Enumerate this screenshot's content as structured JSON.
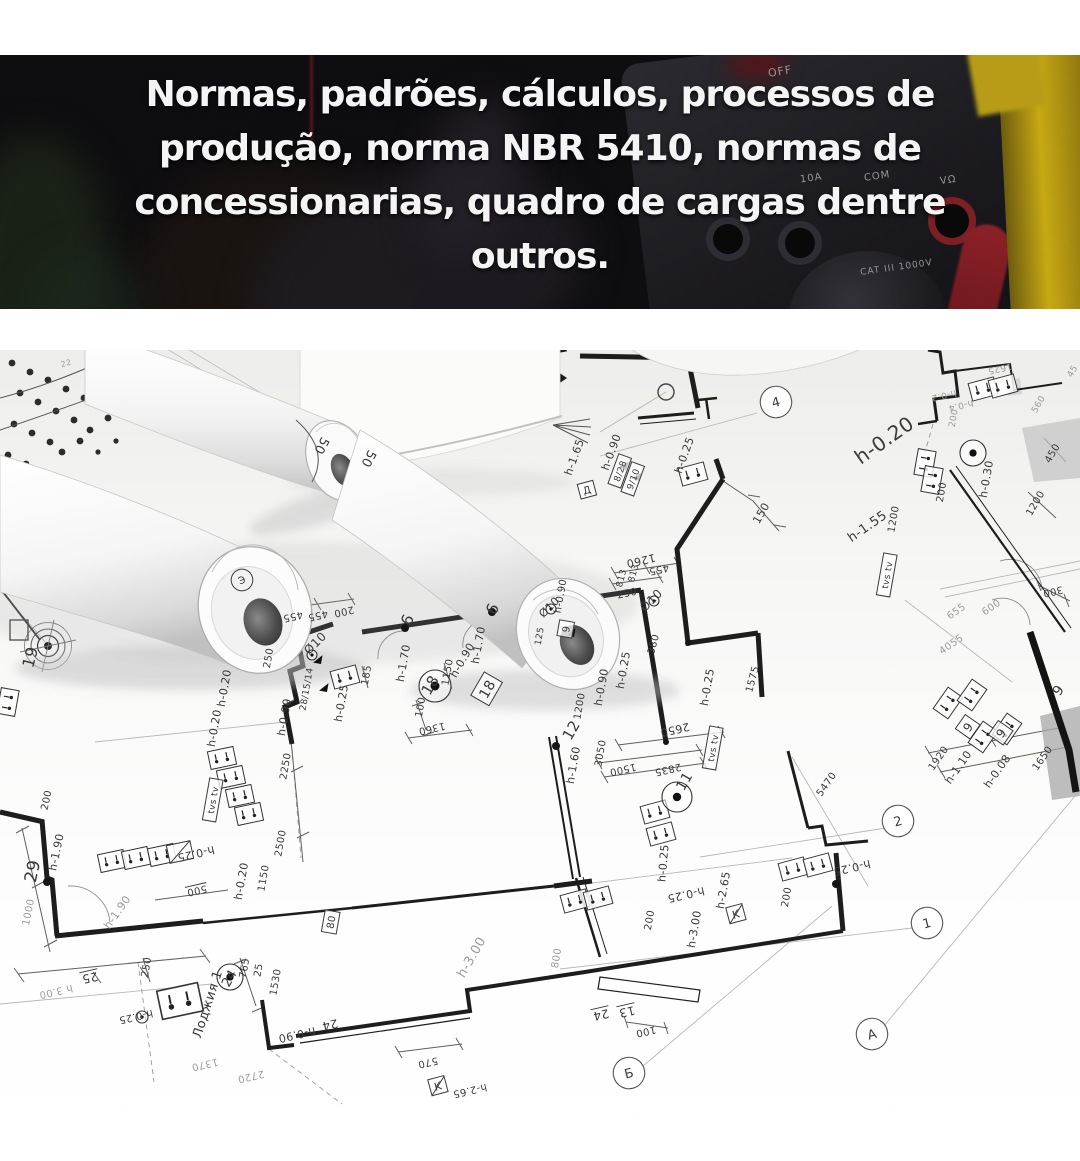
{
  "header": {
    "lines": [
      "Normas, padrões, cálculos, processos de",
      "produção, norma NBR 5410, normas de",
      "concessionarias, quadro de cargas dentre",
      "outros."
    ]
  },
  "photo": {
    "device": "multimeter",
    "accent_yellow": "#c7a912",
    "accent_red": "#7d2026",
    "labels": [
      {
        "t": "OFF",
        "x": 768,
        "y": 10,
        "r": -10,
        "s": 11
      },
      {
        "t": "10A",
        "x": 800,
        "y": 118,
        "r": -8,
        "s": 10
      },
      {
        "t": "COM",
        "x": 864,
        "y": 116,
        "r": -8,
        "s": 10
      },
      {
        "t": "VΩ",
        "x": 940,
        "y": 120,
        "r": -8,
        "s": 10
      },
      {
        "t": "CAT III 1000V",
        "x": 860,
        "y": 208,
        "r": -8,
        "s": 9
      }
    ]
  },
  "blueprint": {
    "labels": [
      {
        "t": "50",
        "x": 322,
        "y": 446,
        "r": 118,
        "s": 13
      },
      {
        "t": "50",
        "x": 369,
        "y": 459,
        "r": 118,
        "s": 13
      },
      {
        "t": "Э",
        "x": 242,
        "y": 580,
        "r": -20,
        "s": 10,
        "o": 1
      },
      {
        "t": "19",
        "x": 30,
        "y": 657,
        "r": -75,
        "s": 16
      },
      {
        "t": "22",
        "x": 66,
        "y": 363,
        "r": -15,
        "s": 8,
        "f": 1
      },
      {
        "t": "4",
        "x": 776,
        "y": 402,
        "r": -15,
        "s": 13,
        "bub": 1
      },
      {
        "t": "h-1.65",
        "x": 574,
        "y": 457,
        "r": -70,
        "s": 11
      },
      {
        "t": "Д",
        "x": 587,
        "y": 490,
        "r": -15,
        "s": 10,
        "box": 1
      },
      {
        "t": "h-0.90",
        "x": 611,
        "y": 452,
        "r": -70,
        "s": 11
      },
      {
        "t": "8/28",
        "x": 620,
        "y": 471,
        "r": -70,
        "s": 9,
        "box": 1
      },
      {
        "t": "9/10",
        "x": 633,
        "y": 479,
        "r": -70,
        "s": 9,
        "box": 1
      },
      {
        "t": "h-0.25",
        "x": 684,
        "y": 455,
        "r": -70,
        "s": 11
      },
      {
        "t": "150",
        "x": 761,
        "y": 513,
        "r": -60,
        "s": 11
      },
      {
        "t": "1260",
        "x": 641,
        "y": 561,
        "r": 167,
        "s": 11
      },
      {
        "t": "813",
        "x": 621,
        "y": 578,
        "r": -75,
        "s": 9
      },
      {
        "t": "813",
        "x": 633,
        "y": 573,
        "r": -75,
        "s": 9
      },
      {
        "t": "455",
        "x": 659,
        "y": 570,
        "r": 167,
        "s": 10
      },
      {
        "t": "250",
        "x": 627,
        "y": 593,
        "r": -12,
        "s": 10
      },
      {
        "t": "Ø10",
        "x": 651,
        "y": 600,
        "r": -45,
        "s": 12
      },
      {
        "t": "380",
        "x": 653,
        "y": 644,
        "r": -75,
        "s": 10
      },
      {
        "t": "h-0.25",
        "x": 623,
        "y": 670,
        "r": -80,
        "s": 11
      },
      {
        "t": "h-0.90",
        "x": 601,
        "y": 687,
        "r": -80,
        "s": 11
      },
      {
        "t": "12",
        "x": 571,
        "y": 730,
        "r": -60,
        "s": 15
      },
      {
        "t": "1200",
        "x": 579,
        "y": 706,
        "r": -80,
        "s": 10
      },
      {
        "t": "2650",
        "x": 675,
        "y": 730,
        "r": 167,
        "s": 11
      },
      {
        "t": "h-0.25",
        "x": 707,
        "y": 687,
        "r": -80,
        "s": 11
      },
      {
        "t": "1575",
        "x": 752,
        "y": 679,
        "r": -75,
        "s": 10
      },
      {
        "t": "455",
        "x": 293,
        "y": 617,
        "r": 167,
        "s": 10
      },
      {
        "t": "455",
        "x": 318,
        "y": 616,
        "r": 167,
        "s": 10
      },
      {
        "t": "200",
        "x": 344,
        "y": 612,
        "r": 167,
        "s": 10
      },
      {
        "t": "250",
        "x": 268,
        "y": 658,
        "r": -80,
        "s": 10
      },
      {
        "t": "Ø10",
        "x": 315,
        "y": 643,
        "r": -45,
        "s": 12
      },
      {
        "t": "28/15/14",
        "x": 306,
        "y": 689,
        "r": -80,
        "s": 9
      },
      {
        "t": "h-0.90",
        "x": 284,
        "y": 717,
        "r": -80,
        "s": 11
      },
      {
        "t": "h-0.25",
        "x": 341,
        "y": 703,
        "r": -80,
        "s": 11
      },
      {
        "t": "h-0.20",
        "x": 224,
        "y": 688,
        "r": -80,
        "s": 11
      },
      {
        "t": "h-0.20",
        "x": 214,
        "y": 728,
        "r": -80,
        "s": 11
      },
      {
        "t": "185",
        "x": 366,
        "y": 675,
        "r": -80,
        "s": 10
      },
      {
        "t": "h-1.70",
        "x": 403,
        "y": 663,
        "r": -80,
        "s": 11
      },
      {
        "t": "9",
        "x": 407,
        "y": 620,
        "r": 115,
        "s": 16
      },
      {
        "t": "9",
        "x": 492,
        "y": 609,
        "r": 115,
        "s": 16
      },
      {
        "t": "100",
        "x": 420,
        "y": 707,
        "r": -80,
        "s": 10
      },
      {
        "t": "18",
        "x": 430,
        "y": 685,
        "r": -60,
        "s": 15
      },
      {
        "t": "1150",
        "x": 447,
        "y": 672,
        "r": -80,
        "s": 10
      },
      {
        "t": "h-0.90",
        "x": 462,
        "y": 660,
        "r": -60,
        "s": 11
      },
      {
        "t": "h-1.70",
        "x": 478,
        "y": 645,
        "r": -80,
        "s": 11
      },
      {
        "t": "18",
        "x": 487,
        "y": 689,
        "r": -60,
        "s": 14,
        "box": 1
      },
      {
        "t": "1360",
        "x": 432,
        "y": 729,
        "r": 167,
        "s": 10
      },
      {
        "t": "125",
        "x": 539,
        "y": 636,
        "r": -80,
        "s": 9
      },
      {
        "t": "Ø10",
        "x": 549,
        "y": 607,
        "r": -45,
        "s": 11
      },
      {
        "t": "h-0.90",
        "x": 560,
        "y": 596,
        "r": -80,
        "s": 10
      },
      {
        "t": "9",
        "x": 566,
        "y": 629,
        "r": -80,
        "s": 10,
        "box": 1
      },
      {
        "t": "h-0.20",
        "x": 884,
        "y": 440,
        "r": -35,
        "s": 20
      },
      {
        "t": "h-1.55",
        "x": 867,
        "y": 526,
        "r": -35,
        "s": 13
      },
      {
        "t": "1200",
        "x": 893,
        "y": 519,
        "r": -80,
        "s": 10
      },
      {
        "t": "tvs tv",
        "x": 887,
        "y": 575,
        "r": -80,
        "s": 9,
        "box": 1
      },
      {
        "t": "200",
        "x": 941,
        "y": 492,
        "r": -80,
        "s": 10
      },
      {
        "t": "h-0.30",
        "x": 986,
        "y": 479,
        "r": -80,
        "s": 11
      },
      {
        "t": "1200",
        "x": 1035,
        "y": 503,
        "r": -60,
        "s": 10
      },
      {
        "t": "450",
        "x": 1052,
        "y": 453,
        "r": -60,
        "s": 10
      },
      {
        "t": "560",
        "x": 1038,
        "y": 404,
        "r": -60,
        "s": 9,
        "f": 1
      },
      {
        "t": "45",
        "x": 1072,
        "y": 371,
        "r": -60,
        "s": 9,
        "f": 1
      },
      {
        "t": "300",
        "x": 1053,
        "y": 592,
        "r": 167,
        "s": 10
      },
      {
        "t": "655",
        "x": 956,
        "y": 611,
        "r": -35,
        "s": 10,
        "f": 1
      },
      {
        "t": "600",
        "x": 991,
        "y": 607,
        "r": -35,
        "s": 10,
        "f": 1
      },
      {
        "t": "4055",
        "x": 951,
        "y": 644,
        "r": -35,
        "s": 10,
        "f": 1
      },
      {
        "t": "1625",
        "x": 1000,
        "y": 369,
        "r": 167,
        "s": 9,
        "f": 1
      },
      {
        "t": "h-0.2",
        "x": 944,
        "y": 396,
        "r": 167,
        "s": 9,
        "f": 1
      },
      {
        "t": "h-0.4",
        "x": 961,
        "y": 406,
        "r": 167,
        "s": 9,
        "f": 1
      },
      {
        "t": "200",
        "x": 953,
        "y": 418,
        "r": -80,
        "s": 9,
        "f": 1
      },
      {
        "t": "9",
        "x": 1058,
        "y": 690,
        "r": -55,
        "s": 14
      },
      {
        "t": "h-1.10",
        "x": 958,
        "y": 767,
        "r": -55,
        "s": 11
      },
      {
        "t": "9",
        "x": 968,
        "y": 727,
        "r": -55,
        "s": 12,
        "box": 1
      },
      {
        "t": "h-0.08",
        "x": 997,
        "y": 771,
        "r": -55,
        "s": 11
      },
      {
        "t": "9",
        "x": 1001,
        "y": 733,
        "r": -55,
        "s": 12,
        "box": 1
      },
      {
        "t": "1920",
        "x": 938,
        "y": 758,
        "r": -55,
        "s": 10
      },
      {
        "t": "1650",
        "x": 1042,
        "y": 758,
        "r": -55,
        "s": 10
      },
      {
        "t": "5470",
        "x": 826,
        "y": 784,
        "r": -55,
        "s": 10
      },
      {
        "t": "2",
        "x": 898,
        "y": 821,
        "r": -15,
        "s": 13,
        "bub": 1
      },
      {
        "t": "1",
        "x": 927,
        "y": 923,
        "r": -15,
        "s": 13,
        "bub": 1
      },
      {
        "t": "А",
        "x": 872,
        "y": 1034,
        "r": -15,
        "s": 13,
        "bub": 1
      },
      {
        "t": "Б",
        "x": 629,
        "y": 1073,
        "r": -15,
        "s": 13,
        "bub": 1
      },
      {
        "t": "h-1.60",
        "x": 573,
        "y": 765,
        "r": -80,
        "s": 11
      },
      {
        "t": "3050",
        "x": 600,
        "y": 753,
        "r": -80,
        "s": 10
      },
      {
        "t": "1500",
        "x": 623,
        "y": 770,
        "r": 167,
        "s": 10
      },
      {
        "t": "2835",
        "x": 668,
        "y": 770,
        "r": 167,
        "s": 10
      },
      {
        "t": "11",
        "x": 684,
        "y": 781,
        "r": -60,
        "s": 14
      },
      {
        "t": "h-0.25",
        "x": 663,
        "y": 863,
        "r": -85,
        "s": 11
      },
      {
        "t": "h-0.25",
        "x": 686,
        "y": 895,
        "r": 167,
        "s": 11
      },
      {
        "t": "h-2.65",
        "x": 723,
        "y": 890,
        "r": -80,
        "s": 11
      },
      {
        "t": "K",
        "x": 736,
        "y": 914,
        "r": -15,
        "s": 11,
        "box": 1,
        "slash": 1
      },
      {
        "t": "h-3.00",
        "x": 694,
        "y": 929,
        "r": -80,
        "s": 11
      },
      {
        "t": "200",
        "x": 649,
        "y": 920,
        "r": -80,
        "s": 10
      },
      {
        "t": "200",
        "x": 786,
        "y": 897,
        "r": -80,
        "s": 10
      },
      {
        "t": "h-0.25",
        "x": 852,
        "y": 868,
        "r": 167,
        "s": 11
      },
      {
        "t": "tvs tv",
        "x": 713,
        "y": 748,
        "r": -80,
        "s": 9,
        "box": 1
      },
      {
        "t": "800",
        "x": 556,
        "y": 958,
        "r": -80,
        "s": 10,
        "f": 1
      },
      {
        "t": "h-3.00",
        "x": 471,
        "y": 957,
        "r": -60,
        "s": 13,
        "f": 1
      },
      {
        "t": "24",
        "x": 601,
        "y": 1015,
        "r": 167,
        "s": 12,
        "u": 1
      },
      {
        "t": "13",
        "x": 627,
        "y": 1012,
        "r": 167,
        "s": 12,
        "u": 1
      },
      {
        "t": "100",
        "x": 646,
        "y": 1032,
        "r": 167,
        "s": 10
      },
      {
        "t": "570",
        "x": 428,
        "y": 1063,
        "r": 167,
        "s": 10
      },
      {
        "t": "K",
        "x": 438,
        "y": 1086,
        "r": -15,
        "s": 11,
        "box": 1,
        "slash": 1
      },
      {
        "t": "h-2.65",
        "x": 470,
        "y": 1091,
        "r": 167,
        "s": 10
      },
      {
        "t": "24",
        "x": 330,
        "y": 1025,
        "r": 167,
        "s": 12
      },
      {
        "t": "h-0.90",
        "x": 297,
        "y": 1035,
        "r": 167,
        "s": 11
      },
      {
        "t": "80",
        "x": 331,
        "y": 922,
        "r": -80,
        "s": 10,
        "box": 1
      },
      {
        "t": "29",
        "x": 32,
        "y": 871,
        "r": -78,
        "s": 17
      },
      {
        "t": "h-1.90",
        "x": 56,
        "y": 852,
        "r": -78,
        "s": 11
      },
      {
        "t": "200",
        "x": 46,
        "y": 800,
        "r": -78,
        "s": 10
      },
      {
        "t": "1000",
        "x": 28,
        "y": 912,
        "r": -78,
        "s": 10,
        "f": 1
      },
      {
        "t": "h-1.90",
        "x": 117,
        "y": 912,
        "r": -55,
        "s": 11,
        "f": 1
      },
      {
        "t": "500",
        "x": 197,
        "y": 891,
        "r": 167,
        "s": 10,
        "u": 1
      },
      {
        "t": "h-0.25",
        "x": 196,
        "y": 854,
        "r": 167,
        "s": 11
      },
      {
        "t": "h-0.20",
        "x": 241,
        "y": 881,
        "r": -80,
        "s": 11
      },
      {
        "t": "1150",
        "x": 263,
        "y": 878,
        "r": -80,
        "s": 10
      },
      {
        "t": "2500",
        "x": 280,
        "y": 843,
        "r": -80,
        "s": 10
      },
      {
        "t": "2250",
        "x": 285,
        "y": 766,
        "r": -80,
        "s": 10
      },
      {
        "t": "tvs tv",
        "x": 213,
        "y": 800,
        "r": -80,
        "s": 9,
        "box": 1
      },
      {
        "t": "25",
        "x": 90,
        "y": 978,
        "r": 167,
        "s": 12,
        "u": 1
      },
      {
        "t": "h 3.00",
        "x": 56,
        "y": 992,
        "r": 167,
        "s": 10,
        "f": 1
      },
      {
        "t": "h-0.25",
        "x": 136,
        "y": 1017,
        "r": 167,
        "s": 10
      },
      {
        "t": "250",
        "x": 146,
        "y": 967,
        "r": -80,
        "s": 10
      },
      {
        "t": "Лоджия 1",
        "x": 207,
        "y": 1004,
        "r": -72,
        "s": 13
      },
      {
        "t": "24",
        "x": 229,
        "y": 978,
        "r": -60,
        "s": 13
      },
      {
        "t": "765",
        "x": 244,
        "y": 968,
        "r": -80,
        "s": 10
      },
      {
        "t": "25",
        "x": 258,
        "y": 970,
        "r": -80,
        "s": 10
      },
      {
        "t": "1530",
        "x": 275,
        "y": 982,
        "r": -80,
        "s": 10
      },
      {
        "t": "1370",
        "x": 205,
        "y": 1065,
        "r": 167,
        "s": 10,
        "f": 1
      },
      {
        "t": "2720",
        "x": 251,
        "y": 1077,
        "r": 167,
        "s": 10,
        "f": 1
      }
    ],
    "symbols": [
      {
        "type": "sock",
        "x": 693,
        "y": 474,
        "r": -15
      },
      {
        "type": "sock",
        "x": 345,
        "y": 677,
        "r": -15
      },
      {
        "type": "sock",
        "x": 112,
        "y": 861,
        "r": -12
      },
      {
        "type": "sock",
        "x": 136,
        "y": 858,
        "r": -12
      },
      {
        "type": "sock",
        "x": 162,
        "y": 855,
        "r": -12
      },
      {
        "type": "boxk",
        "x": 180,
        "y": 852,
        "r": -12
      },
      {
        "type": "sock",
        "x": 222,
        "y": 758,
        "r": -12
      },
      {
        "type": "sock",
        "x": 231,
        "y": 777,
        "r": -12
      },
      {
        "type": "sock",
        "x": 240,
        "y": 796,
        "r": -12
      },
      {
        "type": "sock",
        "x": 249,
        "y": 814,
        "r": -12
      },
      {
        "type": "sock",
        "x": 180,
        "y": 1001,
        "r": -12,
        "k": 1.6
      },
      {
        "type": "sock",
        "x": 655,
        "y": 812,
        "r": -15
      },
      {
        "type": "sock",
        "x": 661,
        "y": 834,
        "r": -15
      },
      {
        "type": "sock",
        "x": 575,
        "y": 901,
        "r": -15
      },
      {
        "type": "sock",
        "x": 598,
        "y": 898,
        "r": -15
      },
      {
        "type": "sock",
        "x": 793,
        "y": 869,
        "r": -15
      },
      {
        "type": "sock",
        "x": 818,
        "y": 865,
        "r": -15
      },
      {
        "type": "sock",
        "x": 948,
        "y": 703,
        "r": -55
      },
      {
        "type": "sock",
        "x": 972,
        "y": 695,
        "r": -55
      },
      {
        "type": "sock",
        "x": 983,
        "y": 737,
        "r": -55
      },
      {
        "type": "sock",
        "x": 1007,
        "y": 729,
        "r": -55
      },
      {
        "type": "sock",
        "x": 925,
        "y": 463,
        "r": -80
      },
      {
        "type": "sock",
        "x": 932,
        "y": 480,
        "r": -80
      },
      {
        "type": "sock",
        "x": 983,
        "y": 389,
        "r": -15
      },
      {
        "type": "sock",
        "x": 1003,
        "y": 386,
        "r": -15
      },
      {
        "type": "sock",
        "x": 8,
        "y": 702,
        "r": -80
      },
      {
        "type": "cdot",
        "x": 677,
        "y": 797,
        "d": 15
      },
      {
        "type": "cdot",
        "x": 435,
        "y": 686,
        "d": 16
      },
      {
        "type": "cdot",
        "x": 230,
        "y": 977,
        "d": 13
      },
      {
        "type": "cdot",
        "x": 142,
        "y": 1017,
        "d": 6
      },
      {
        "type": "cdot",
        "x": 312,
        "y": 655,
        "d": 5
      },
      {
        "type": "cdot",
        "x": 654,
        "y": 601,
        "d": 5
      },
      {
        "type": "cdot",
        "x": 551,
        "y": 609,
        "d": 5
      },
      {
        "type": "cdot",
        "x": 973,
        "y": 453,
        "d": 13
      },
      {
        "type": "dot",
        "x": 47,
        "y": 882,
        "d": 4
      },
      {
        "type": "dot",
        "x": 405,
        "y": 628,
        "d": 4
      },
      {
        "type": "dot",
        "x": 492,
        "y": 612,
        "d": 4
      },
      {
        "type": "dot",
        "x": 556,
        "y": 746,
        "d": 4
      },
      {
        "type": "dot",
        "x": 836,
        "y": 884,
        "d": 4
      },
      {
        "type": "dot",
        "x": 666,
        "y": 742,
        "d": 3
      },
      {
        "type": "dot",
        "x": 688,
        "y": 643,
        "d": 3
      },
      {
        "type": "tri",
        "x": 321,
        "y": 664,
        "r": -80
      },
      {
        "type": "tri",
        "x": 327,
        "y": 692,
        "r": -80
      },
      {
        "type": "tri",
        "x": 626,
        "y": 470,
        "r": -70
      },
      {
        "type": "tri",
        "x": 639,
        "y": 481,
        "r": -70
      },
      {
        "type": "tri",
        "x": 574,
        "y": 637,
        "r": -80
      }
    ]
  }
}
